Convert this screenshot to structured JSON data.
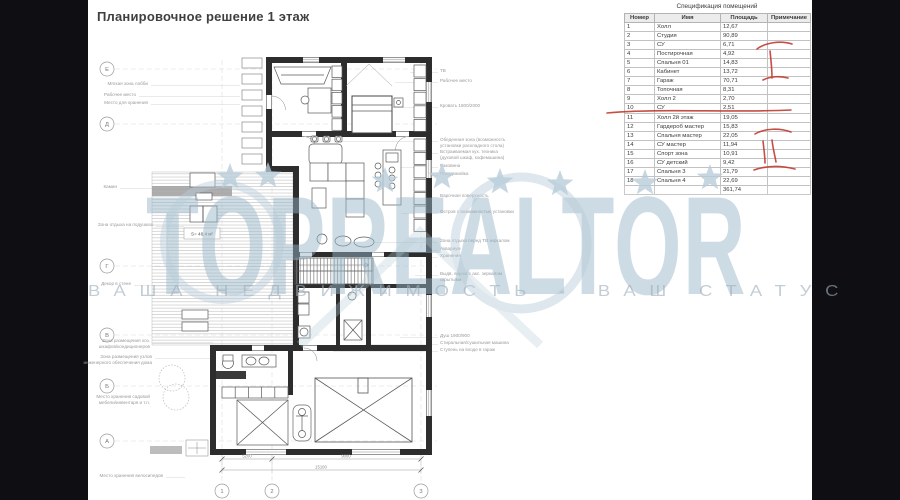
{
  "page": {
    "title": "Планировочное решение 1 этаж"
  },
  "table": {
    "title": "Спецификация помещений",
    "columns": [
      "Номер",
      "Имя",
      "Площадь",
      "Примечание"
    ],
    "rows": [
      [
        "1",
        "Холл",
        "12,67",
        ""
      ],
      [
        "2",
        "Студия",
        "90,89",
        ""
      ],
      [
        "3",
        "СУ",
        "6,71",
        ""
      ],
      [
        "4",
        "Постирочная",
        "4,92",
        ""
      ],
      [
        "5",
        "Спальня 01",
        "14,83",
        ""
      ],
      [
        "6",
        "Кабинет",
        "13,72",
        ""
      ],
      [
        "7",
        "Гараж",
        "70,71",
        ""
      ],
      [
        "8",
        "Топочная",
        "8,31",
        ""
      ],
      [
        "9",
        "Холл 2",
        "2,70",
        ""
      ],
      [
        "10",
        "СУ",
        "2,51",
        ""
      ],
      [
        "11",
        "Холл 2й этаж",
        "19,05",
        ""
      ],
      [
        "12",
        "Гардероб мастер",
        "15,83",
        ""
      ],
      [
        "13",
        "Спальня мастер",
        "22,05",
        ""
      ],
      [
        "14",
        "СУ мастер",
        "11,94",
        ""
      ],
      [
        "15",
        "Спорт зона",
        "10,91",
        ""
      ],
      [
        "16",
        "СУ детский",
        "9,42",
        ""
      ],
      [
        "17",
        "Спальня 3",
        "21,79",
        ""
      ],
      [
        "18",
        "Спальня 4",
        "22,69",
        ""
      ]
    ],
    "total": "361,74"
  },
  "plan": {
    "terrace_area_label": "S= 48,4 м²",
    "axes_left": [
      {
        "label": "Е",
        "y": 69
      },
      {
        "label": "Д",
        "y": 124
      },
      {
        "label": "Г",
        "y": 266
      },
      {
        "label": "В",
        "y": 335
      },
      {
        "label": "Б",
        "y": 386
      },
      {
        "label": "А",
        "y": 441
      }
    ],
    "axes_bottom": [
      {
        "label": "1",
        "x": 222
      },
      {
        "label": "2",
        "x": 272
      },
      {
        "label": "3",
        "x": 421
      }
    ],
    "dimensions": [
      {
        "text": "5200",
        "x": 247,
        "y": 457.5
      },
      {
        "text": "9000",
        "x": 346,
        "y": 457.5
      },
      {
        "text": "15100",
        "x": 321,
        "y": 468.5
      }
    ],
    "annotations_left": [
      {
        "lines": [
          "Мягкая зона лобби"
        ],
        "x": 148,
        "y": 84,
        "lead": 240
      },
      {
        "lines": [
          "Рабочее место"
        ],
        "x": 136,
        "y": 95,
        "lead": 240
      },
      {
        "lines": [
          "Место для хранения"
        ],
        "x": 148,
        "y": 103,
        "lead": 240
      },
      {
        "lines": [
          "Камин"
        ],
        "x": 117,
        "y": 187,
        "lead": 190
      },
      {
        "lines": [
          "Зона отдыха на подушках"
        ],
        "x": 153,
        "y": 225,
        "lead": 184
      },
      {
        "lines": [
          "Декор в стене"
        ],
        "x": 131,
        "y": 284,
        "lead": 293
      },
      {
        "lines": [
          "Зона размещения хоз.",
          "шкафов/кондиционеров"
        ],
        "x": 150,
        "y": 341,
        "lead": 213
      },
      {
        "lines": [
          "Зона размещения узлов",
          "инженерного обеспечения дома"
        ],
        "x": 152,
        "y": 357,
        "lead": 216
      },
      {
        "lines": [
          "Место хранения садовой",
          "мебели/инвентаря и т.п."
        ],
        "x": 150,
        "y": 397,
        "lead": null
      },
      {
        "lines": [
          "Место хранения велосипедов"
        ],
        "x": 163,
        "y": 476,
        "lead": 185
      }
    ],
    "annotations_right": [
      {
        "lines": [
          "ТВ"
        ],
        "x": 440,
        "y": 71,
        "lead": 410
      },
      {
        "lines": [
          "Рабочее место"
        ],
        "x": 440,
        "y": 81,
        "lead": 395
      },
      {
        "lines": [
          "Кровать 1800/2000"
        ],
        "x": 440,
        "y": 106,
        "lead": 392
      },
      {
        "lines": [
          "Обеденная зона (возможность",
          "установки раскладного стола)"
        ],
        "x": 440,
        "y": 140,
        "lead": 342
      },
      {
        "lines": [
          "Встраиваемая кух. техника",
          "(духовой шкаф, кофемашина)"
        ],
        "x": 440,
        "y": 152,
        "lead": 427
      },
      {
        "lines": [
          "Раковина"
        ],
        "x": 440,
        "y": 166,
        "lead": 401
      },
      {
        "lines": [
          "Посудомойка"
        ],
        "x": 440,
        "y": 174,
        "lead": 427
      },
      {
        "lines": [
          "Варочная поверхность"
        ],
        "x": 440,
        "y": 196,
        "lead": 401
      },
      {
        "lines": [
          "Остров с возможностью установки"
        ],
        "x": 440,
        "y": 212,
        "lead": 401
      },
      {
        "lines": [
          "Зона отдыха перед ТВ зеркалом"
        ],
        "x": 440,
        "y": 241,
        "lead": 370
      },
      {
        "lines": [
          "Аквариум"
        ],
        "x": 440,
        "y": 249,
        "lead": 427
      },
      {
        "lines": [
          "Хранение"
        ],
        "x": 440,
        "y": 256,
        "lead": 427
      },
      {
        "lines": [
          "Выдв. ящики с акс. зеркалом",
          "скрытыми"
        ],
        "x": 440,
        "y": 274,
        "lead": 415
      },
      {
        "lines": [
          "Душ 1900/900"
        ],
        "x": 440,
        "y": 336,
        "lead": 400
      },
      {
        "lines": [
          "Стиральная/сушильная машина"
        ],
        "x": 440,
        "y": 343,
        "lead": 365
      },
      {
        "lines": [
          "Ступень на входе в гараж"
        ],
        "x": 440,
        "y": 350,
        "lead": 333
      }
    ]
  },
  "watermark": {
    "brand": "TOPREALTOR",
    "tagline": "ВАША НЕДВИЖИМОСТЬ - ВАШ СТАТУС",
    "color": "#b7ccd9",
    "stars": [
      {
        "x": 230,
        "y": 177
      },
      {
        "x": 268,
        "y": 176
      },
      {
        "x": 385,
        "y": 181
      },
      {
        "x": 442,
        "y": 177
      },
      {
        "x": 500,
        "y": 182
      },
      {
        "x": 560,
        "y": 184
      },
      {
        "x": 645,
        "y": 183
      },
      {
        "x": 710,
        "y": 178
      }
    ]
  },
  "colors": {
    "accent_red": "#c23b30",
    "frame_bg": "#0e0e13",
    "page_bg": "#ffffff"
  }
}
